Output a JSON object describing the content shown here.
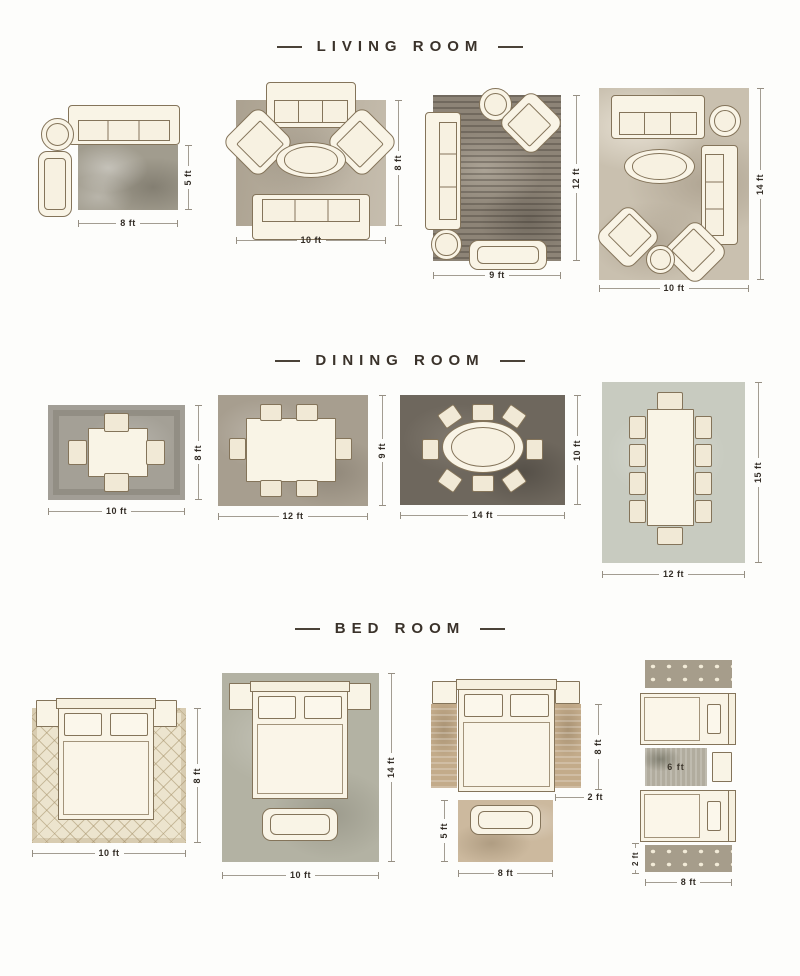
{
  "headers": {
    "living": "LIVING ROOM",
    "dining": "DINING ROOM",
    "bed": "BED ROOM"
  },
  "living": {
    "l1": {
      "w": "8 ft",
      "h": "5 ft"
    },
    "l2": {
      "w": "10 ft",
      "h": "8 ft"
    },
    "l3": {
      "w": "9 ft",
      "h": "12 ft"
    },
    "l4": {
      "w": "10 ft",
      "h": "14 ft"
    }
  },
  "dining": {
    "l1": {
      "w": "10 ft",
      "h": "8 ft"
    },
    "l2": {
      "w": "12 ft",
      "h": "9 ft"
    },
    "l3": {
      "w": "14 ft",
      "h": "10 ft"
    },
    "l4": {
      "w": "12 ft",
      "h": "15 ft"
    }
  },
  "bed": {
    "l1": {
      "w": "10 ft",
      "h": "8 ft"
    },
    "l2": {
      "w": "10 ft",
      "h": "14 ft"
    },
    "l3": {
      "w": "8 ft",
      "runner_h": "8 ft",
      "runner_w": "2 ft",
      "foot_h": "5 ft"
    },
    "l4": {
      "w": "8 ft",
      "mid_rug_w": "6 ft",
      "runner_w": "2 ft"
    }
  },
  "colors": {
    "text": "#3a322a",
    "furniture_fill": "#f9f4e6",
    "furniture_outline": "#84745a",
    "background": "#fdfdfb"
  }
}
